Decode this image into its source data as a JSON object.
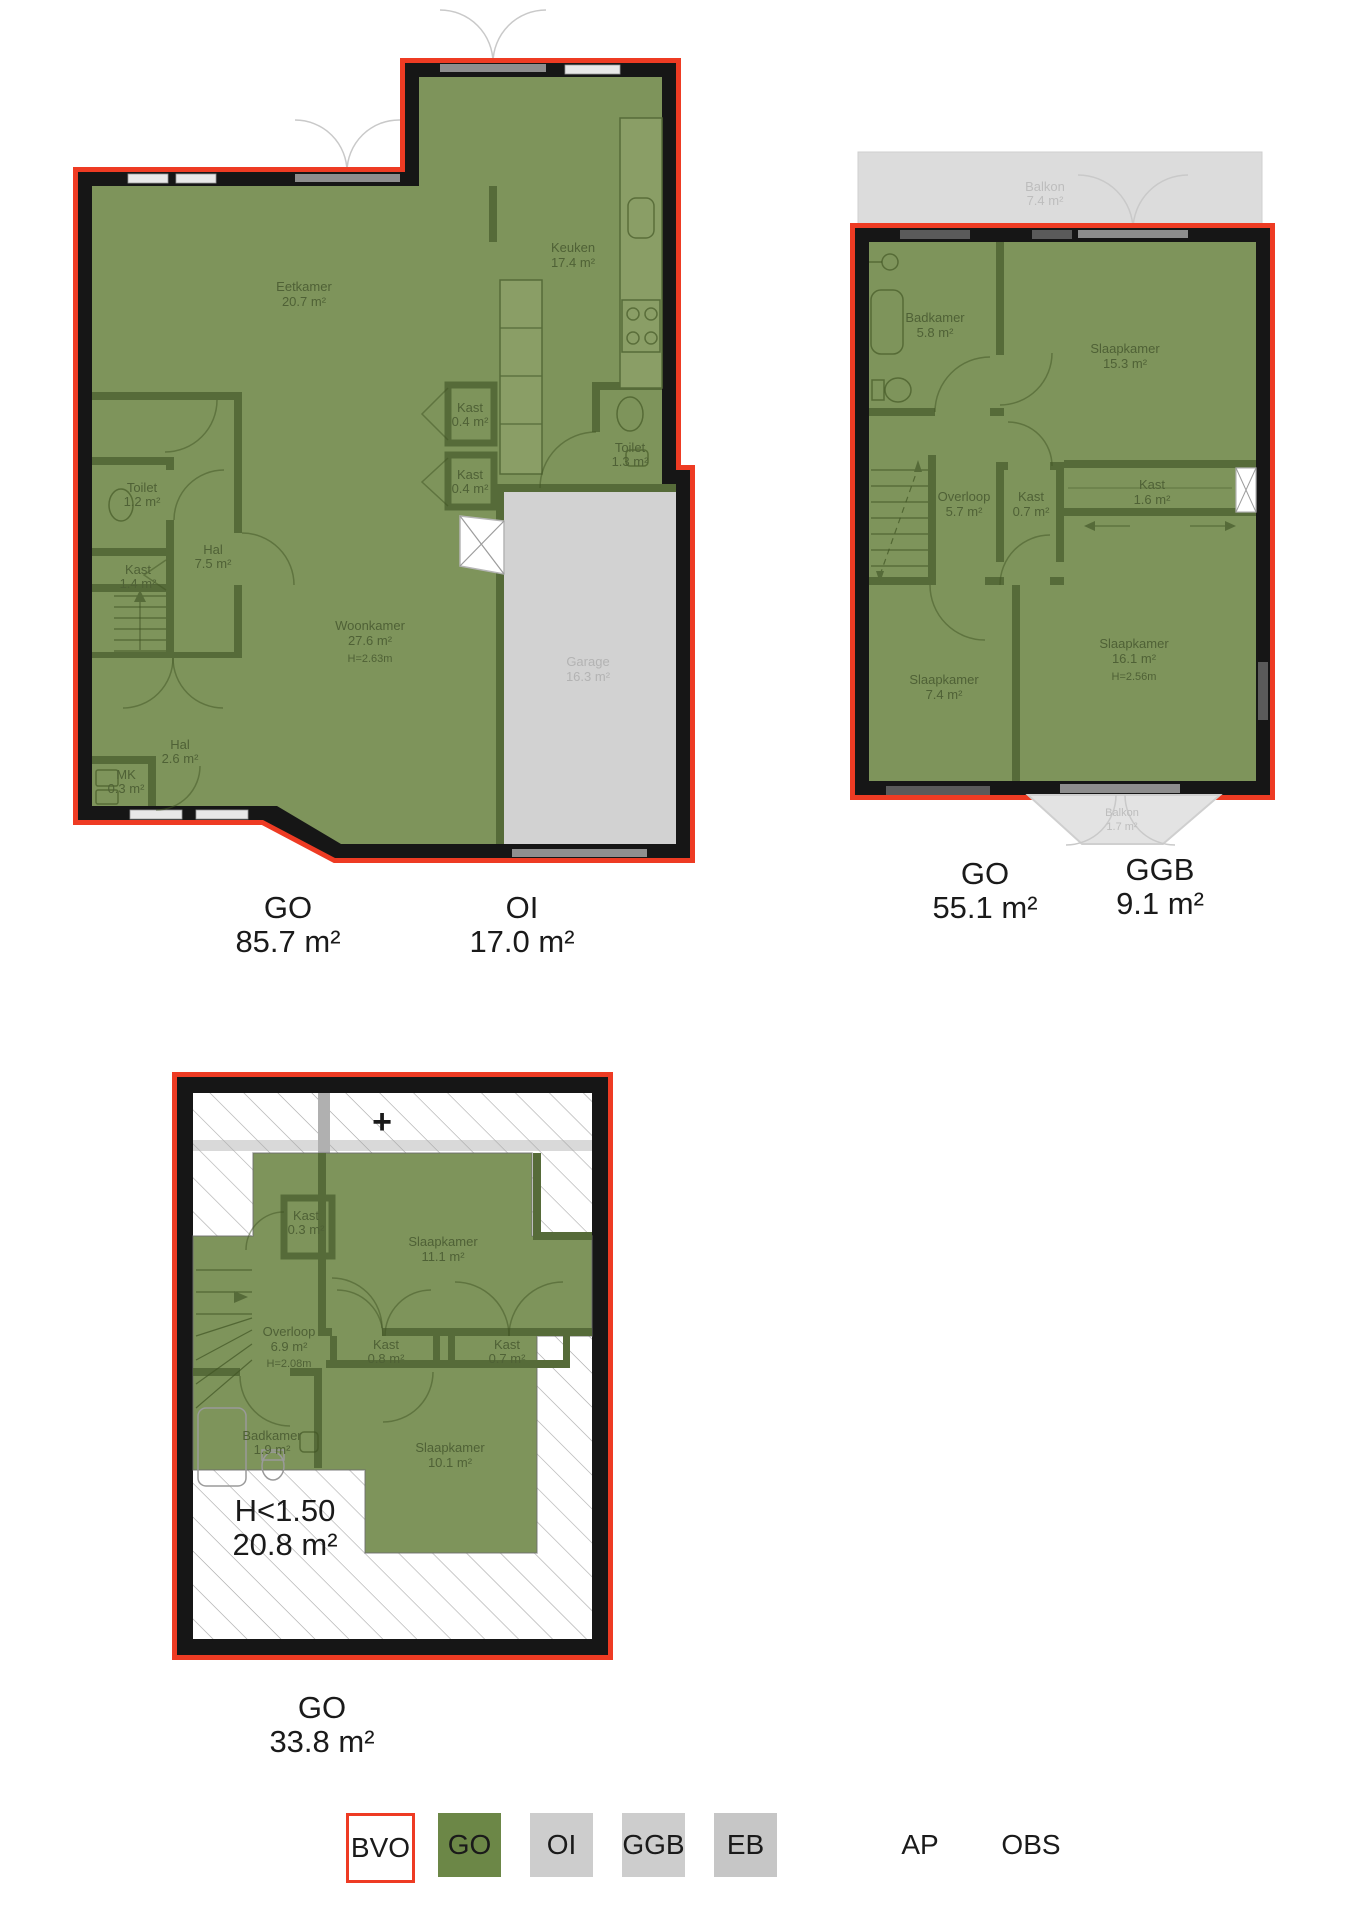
{
  "colors": {
    "bvo_outline_red": "#ee3b23",
    "go_green": "#6c8747",
    "plan_fill_green": "#7e945b",
    "wall_black": "#161616",
    "oi_gray": "#d2d2d2",
    "ggb_gray": "#dcdcdc"
  },
  "plans": {
    "ground": {
      "rooms": {
        "eetkamer": {
          "name": "Eetkamer",
          "area": "20.7 m²"
        },
        "keuken": {
          "name": "Keuken",
          "area": "17.4 m²"
        },
        "kast_top": {
          "name": "Kast",
          "area": "0.4 m²"
        },
        "kast_bottom": {
          "name": "Kast",
          "area": "0.4 m²"
        },
        "toilet_right": {
          "name": "Toilet",
          "area": "1.3 m²"
        },
        "toilet_left": {
          "name": "Toilet",
          "area": "1.2 m²"
        },
        "kast_left": {
          "name": "Kast",
          "area": "1.4 m²"
        },
        "hal": {
          "name": "Hal",
          "area": "7.5 m²"
        },
        "woonkamer": {
          "name": "Woonkamer",
          "area": "27.6 m²",
          "height": "H=2.63m"
        },
        "hal2": {
          "name": "Hal",
          "area": "2.6 m²"
        },
        "mk": {
          "name": "MK",
          "area": "0.3 m²"
        },
        "garage": {
          "name": "Garage",
          "area": "16.3 m²"
        }
      },
      "totals": {
        "go": {
          "code": "GO",
          "area": "85.7 m²"
        },
        "oi": {
          "code": "OI",
          "area": "17.0 m²"
        }
      }
    },
    "first": {
      "rooms": {
        "balkon_top": {
          "name": "Balkon",
          "area": "7.4 m²"
        },
        "badkamer": {
          "name": "Badkamer",
          "area": "5.8 m²"
        },
        "slaapkamer1": {
          "name": "Slaapkamer",
          "area": "15.3 m²"
        },
        "overloop": {
          "name": "Overloop",
          "area": "5.7 m²"
        },
        "kast1": {
          "name": "Kast",
          "area": "0.7 m²"
        },
        "kast2": {
          "name": "Kast",
          "area": "1.6 m²"
        },
        "slaapkamer2": {
          "name": "Slaapkamer",
          "area": "7.4 m²"
        },
        "slaapkamer3": {
          "name": "Slaapkamer",
          "area": "16.1 m²",
          "height": "H=2.56m"
        },
        "balkon_bottom": {
          "name": "Balkon",
          "area": "1.7 m²"
        }
      },
      "totals": {
        "go": {
          "code": "GO",
          "area": "55.1 m²"
        },
        "ggb": {
          "code": "GGB",
          "area": "9.1 m²"
        }
      }
    },
    "attic": {
      "symbols": {
        "plus": "+"
      },
      "rooms": {
        "kast_small": {
          "name": "Kast",
          "area": "0.3 m²"
        },
        "slaapkamer1": {
          "name": "Slaapkamer",
          "area": "11.1 m²"
        },
        "overloop": {
          "name": "Overloop",
          "area": "6.9 m²",
          "height": "H=2.08m"
        },
        "kast1": {
          "name": "Kast",
          "area": "0.8 m²"
        },
        "kast2": {
          "name": "Kast",
          "area": "0.7 m²"
        },
        "badkamer": {
          "name": "Badkamer",
          "area": "1.9 m²"
        },
        "slaapkamer2": {
          "name": "Slaapkamer",
          "area": "10.1 m²"
        },
        "low_height": {
          "name": "H<1.50",
          "area": "20.8 m²"
        }
      },
      "totals": {
        "go": {
          "code": "GO",
          "area": "33.8 m²"
        }
      }
    }
  },
  "legend": {
    "items": [
      {
        "code": "BVO"
      },
      {
        "code": "GO"
      },
      {
        "code": "OI"
      },
      {
        "code": "GGB"
      },
      {
        "code": "EB"
      },
      {
        "code": "AP"
      },
      {
        "code": "OBS"
      }
    ]
  }
}
